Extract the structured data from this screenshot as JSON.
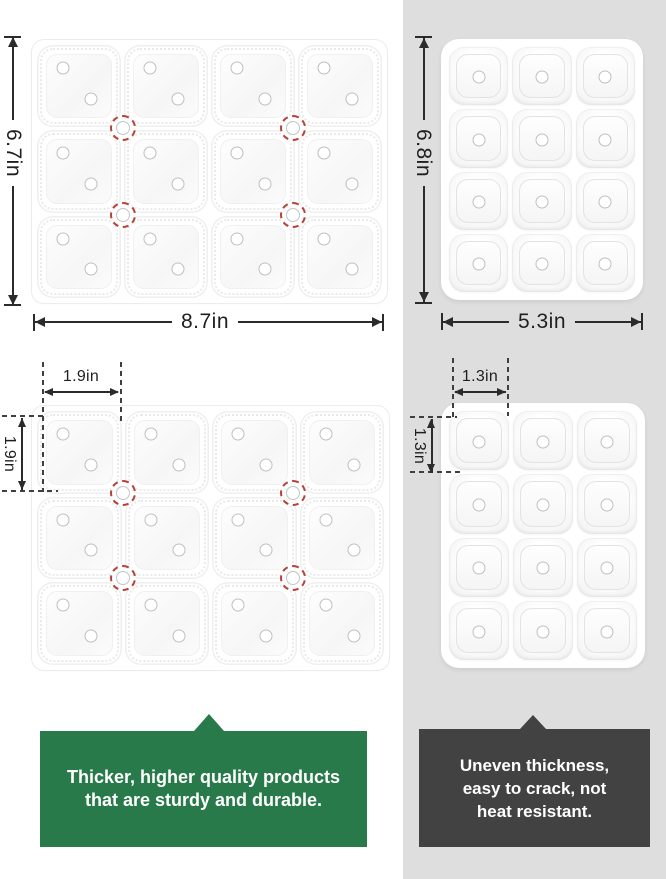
{
  "trays": {
    "top_left": {
      "rows": 3,
      "cols": 4,
      "dots_per_cell": 2,
      "height_label": "6.7in",
      "width_label": "8.7in"
    },
    "top_right": {
      "rows": 4,
      "cols": 3,
      "dots_per_cell": 1,
      "height_label": "6.8in",
      "width_label": "5.3in"
    },
    "mid_left": {
      "rows": 3,
      "cols": 4,
      "dots_per_cell": 2,
      "cell_width_label": "1.9in",
      "cell_height_label": "1.9in"
    },
    "mid_right": {
      "rows": 4,
      "cols": 3,
      "dots_per_cell": 1,
      "cell_width_label": "1.3in",
      "cell_height_label": "1.3in"
    }
  },
  "callouts": {
    "good": {
      "lines": [
        "Thicker, higher quality products",
        "that are sturdy and durable."
      ]
    },
    "bad": {
      "lines": [
        "Uneven thickness,",
        "easy to crack, not",
        "heat resistant."
      ]
    }
  },
  "colors": {
    "good": "#297a4b",
    "bad": "#424242",
    "panel": "#dedede",
    "red": "#b5423a",
    "ink": "#2b2b2b"
  }
}
